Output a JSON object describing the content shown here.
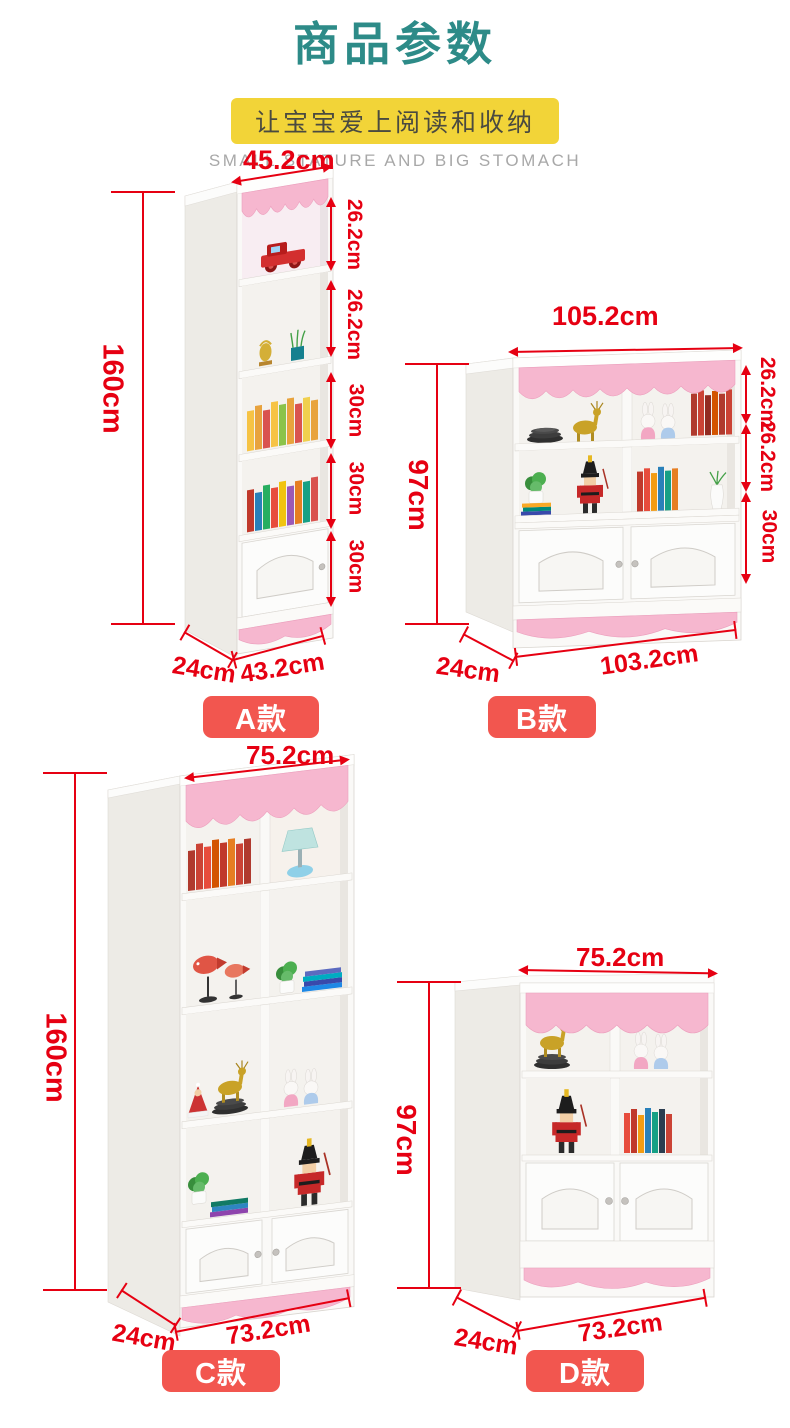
{
  "header": {
    "title": "商品参数",
    "tagline": "让宝宝爱上阅读和收纳",
    "subtitle": "SMALL STATURE AND BIG STOMACH"
  },
  "colors": {
    "title_teal": "#2d8b88",
    "tagline_yellow": "#f2d438",
    "dimension_red": "#e60012",
    "model_badge_red": "#f2564f",
    "cabinet_pink": "#f6b7cf",
    "cabinet_white": "#faf9f7"
  },
  "models": [
    {
      "name": "A款",
      "top_width": "45.2cm",
      "height": "160cm",
      "depth": "24cm",
      "bottom_width": "43.2cm",
      "segments": [
        "26.2cm",
        "26.2cm",
        "30cm",
        "30cm",
        "30cm"
      ],
      "decor_items": [
        "toy-truck",
        "gold-figurine",
        "potted-grass",
        "books",
        "books",
        "cabinet-door"
      ]
    },
    {
      "name": "B款",
      "top_width": "105.2cm",
      "height": "97cm",
      "depth": "24cm",
      "bottom_width": "103.2cm",
      "segments": [
        "26.2cm",
        "26.2cm",
        "30cm"
      ],
      "decor_items": [
        "plates",
        "gold-deer",
        "rabbit-dolls",
        "books",
        "plant",
        "nutcracker",
        "books",
        "vase",
        "double-doors"
      ]
    },
    {
      "name": "C款",
      "top_width": "75.2cm",
      "height": "160cm",
      "depth": "24cm",
      "bottom_width": "73.2cm",
      "segments": [],
      "decor_items": [
        "books",
        "table-lamp",
        "fish-ornament",
        "plant",
        "books",
        "santa-doll",
        "gold-deer",
        "plates",
        "rabbit-dolls",
        "nutcracker",
        "double-doors"
      ]
    },
    {
      "name": "D款",
      "top_width": "75.2cm",
      "height": "97cm",
      "depth": "24cm",
      "bottom_width": "73.2cm",
      "segments": [],
      "decor_items": [
        "gold-deer",
        "plates",
        "rabbit-dolls",
        "nutcracker",
        "books",
        "double-doors"
      ]
    }
  ]
}
